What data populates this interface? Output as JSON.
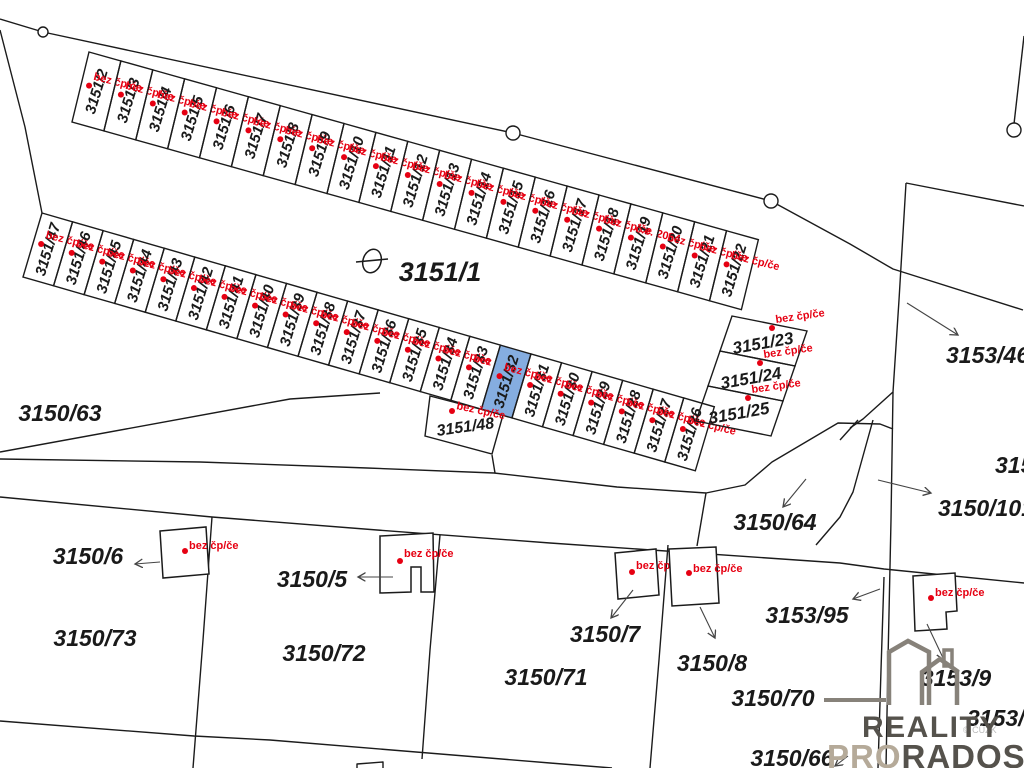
{
  "map": {
    "colors": {
      "background": "#ffffff",
      "line": "#1b1b1b",
      "label": "#1a1a1a",
      "red": "#e60012",
      "highlight_fill": "#85ade0",
      "arrow": "#444444",
      "logo_dark": "#55524c",
      "logo_light": "#b5aa99",
      "watermark_grey": "#bcbcbc"
    },
    "strips": [
      {
        "id": "north-row",
        "origin": [
          89,
          52
        ],
        "dir": [
          0.963,
          0.27
        ],
        "spacing": 33.1,
        "side": [
          -17,
          70
        ],
        "num_rot": -73,
        "tag_rot": 14,
        "num_size": 15,
        "tag_size": 11,
        "cells": [
          {
            "num": "3151/2",
            "tag": "bez čp/če"
          },
          {
            "num": "3151/3",
            "tag": "bez čp/če"
          },
          {
            "num": "3151/4",
            "tag": "bez čp/če"
          },
          {
            "num": "3151/5",
            "tag": "bez čp/če"
          },
          {
            "num": "3151/6",
            "tag": "bez čp/če"
          },
          {
            "num": "3151/7",
            "tag": "bez čp/če"
          },
          {
            "num": "3151/8",
            "tag": "bez čp/če"
          },
          {
            "num": "3151/9",
            "tag": "bez čp/če"
          },
          {
            "num": "3151/10",
            "tag": "bez čp/če"
          },
          {
            "num": "3151/11",
            "tag": "bez čp/če"
          },
          {
            "num": "3151/12",
            "tag": "bez čp/če"
          },
          {
            "num": "3151/13",
            "tag": "bez čp/če"
          },
          {
            "num": "3151/14",
            "tag": "bez čp/če"
          },
          {
            "num": "3151/15",
            "tag": "bez čp/če"
          },
          {
            "num": "3151/16",
            "tag": "bez čp/če"
          },
          {
            "num": "3151/17",
            "tag": "bez čp/če"
          },
          {
            "num": "3151/18",
            "tag": "bez čp/če"
          },
          {
            "num": "3151/19",
            "tag": "č.e. 2024"
          },
          {
            "num": "3151/20",
            "tag": "bez čp/če"
          },
          {
            "num": "3151/21",
            "tag": "bez čp/če"
          },
          {
            "num": "3151/22",
            "tag": "bez čp/če"
          }
        ]
      },
      {
        "id": "south-row",
        "origin": [
          42,
          213
        ],
        "dir": [
          0.961,
          0.277
        ],
        "spacing": 31.8,
        "side": [
          -19,
          64
        ],
        "num_rot": -73,
        "tag_rot": 14,
        "num_size": 15,
        "tag_size": 11,
        "cells": [
          {
            "num": "3151/47",
            "tag": "bez čp/če"
          },
          {
            "num": "3151/46",
            "tag": "bez čp/če"
          },
          {
            "num": "3151/45",
            "tag": "bez čp/če"
          },
          {
            "num": "3151/44",
            "tag": "bez čp/če"
          },
          {
            "num": "3151/43",
            "tag": "bez čp/če"
          },
          {
            "num": "3151/42",
            "tag": "bez čp/če"
          },
          {
            "num": "3151/41",
            "tag": "bez čp/če"
          },
          {
            "num": "3151/40",
            "tag": "bez čp/če"
          },
          {
            "num": "3151/39",
            "tag": "bez čp/če"
          },
          {
            "num": "3151/38",
            "tag": "bez čp/če"
          },
          {
            "num": "3151/37",
            "tag": "bez čp/če"
          },
          {
            "num": "3151/36",
            "tag": "bez čp/če"
          },
          {
            "num": "3151/35",
            "tag": "bez čp/če"
          },
          {
            "num": "3151/34",
            "tag": "bez čp/če"
          },
          {
            "num": "3151/33",
            "tag": "bez čp/če"
          },
          {
            "num": "3151/32",
            "tag": "bez čp/če",
            "highlight": true
          },
          {
            "num": "3151/31",
            "tag": "bez čp/če"
          },
          {
            "num": "3151/30",
            "tag": "bez čp/če"
          },
          {
            "num": "3151/29",
            "tag": "bez čp/če"
          },
          {
            "num": "3151/28",
            "tag": "bez čp/če"
          },
          {
            "num": "3151/27",
            "tag": "bez čp/če"
          },
          {
            "num": "3151/26",
            "tag": "bez čp/če"
          }
        ]
      }
    ],
    "east_block": {
      "origin": [
        732,
        316
      ],
      "rowvec": [
        75,
        15
      ],
      "colvec": [
        -12,
        35
      ],
      "num_rot": -10,
      "tag_rot": -8,
      "num_size": 17,
      "tag_size": 11,
      "cells": [
        {
          "num": "3151/23",
          "tag": "bez čp/če"
        },
        {
          "num": "3151/24",
          "tag": "bez čp/če"
        },
        {
          "num": "3151/25",
          "tag": "bez čp/če"
        }
      ]
    },
    "labels": [
      {
        "t": "3151/1",
        "x": 440,
        "y": 281,
        "s": 27
      },
      {
        "t": "3150/63",
        "x": 60,
        "y": 421,
        "s": 23
      },
      {
        "t": "3150/6",
        "x": 88,
        "y": 564,
        "s": 23
      },
      {
        "t": "3150/73",
        "x": 95,
        "y": 646,
        "s": 23
      },
      {
        "t": "3150/5",
        "x": 312,
        "y": 587,
        "s": 23
      },
      {
        "t": "3150/72",
        "x": 324,
        "y": 661,
        "s": 23
      },
      {
        "t": "3150/71",
        "x": 546,
        "y": 685,
        "s": 23
      },
      {
        "t": "3150/7",
        "x": 605,
        "y": 642,
        "s": 23
      },
      {
        "t": "3150/8",
        "x": 712,
        "y": 671,
        "s": 23
      },
      {
        "t": "3150/64",
        "x": 775,
        "y": 530,
        "s": 23
      },
      {
        "t": "3150/70",
        "x": 773,
        "y": 706,
        "s": 23
      },
      {
        "t": "3150/66",
        "x": 792,
        "y": 766,
        "s": 23
      },
      {
        "t": "3153/95",
        "x": 807,
        "y": 623,
        "s": 23
      },
      {
        "t": "3153/9",
        "x": 956,
        "y": 686,
        "s": 23
      },
      {
        "t": "3153/4",
        "x": 967,
        "y": 726,
        "s": 23,
        "anchor": "start"
      },
      {
        "t": "3153/46",
        "x": 946,
        "y": 363,
        "s": 23,
        "anchor": "start"
      },
      {
        "t": "3150/101",
        "x": 938,
        "y": 516,
        "s": 23,
        "anchor": "start"
      },
      {
        "t": "315",
        "x": 995,
        "y": 473,
        "s": 23,
        "anchor": "start"
      },
      {
        "t": "3151/48",
        "x": 466,
        "y": 432,
        "s": 16,
        "rot": -8
      }
    ],
    "buildings": [
      {
        "points": [
          [
            160,
            531
          ],
          [
            206,
            527
          ],
          [
            209,
            574
          ],
          [
            163,
            578
          ]
        ],
        "dot": [
          185,
          551
        ],
        "label": [
          189,
          549
        ],
        "tag": "bez čp/če"
      },
      {
        "points": [
          [
            380,
            536
          ],
          [
            433,
            533
          ],
          [
            434,
            592
          ],
          [
            421,
            592
          ],
          [
            421,
            567
          ],
          [
            411,
            567
          ],
          [
            411,
            592
          ],
          [
            380,
            593
          ]
        ],
        "dot": [
          400,
          561
        ],
        "label": [
          404,
          557
        ],
        "tag": "bez čp/če"
      },
      {
        "points": [
          [
            615,
            553
          ],
          [
            656,
            549
          ],
          [
            659,
            595
          ],
          [
            618,
            599
          ]
        ],
        "dot": [
          632,
          572
        ],
        "label": [
          636,
          569
        ],
        "tag": "bez čp/če"
      },
      {
        "points": [
          [
            669,
            549
          ],
          [
            716,
            547
          ],
          [
            719,
            603
          ],
          [
            672,
            606
          ]
        ],
        "dot": [
          689,
          573
        ],
        "label": [
          693,
          572
        ],
        "tag": "bez čp/če"
      },
      {
        "points": [
          [
            913,
            576
          ],
          [
            955,
            573
          ],
          [
            957,
            611
          ],
          [
            946,
            612
          ],
          [
            947,
            629
          ],
          [
            915,
            631
          ]
        ],
        "dot": [
          931,
          598
        ],
        "label": [
          935,
          596
        ],
        "tag": "bez čp/če"
      }
    ],
    "extra_tags": [
      {
        "dot": [
          452,
          411
        ],
        "label": [
          456,
          409
        ],
        "rot": 12,
        "tag": "bez čp/če"
      }
    ],
    "polylines": [
      {
        "pts": [
          [
            0,
            19
          ],
          [
            43,
            32
          ],
          [
            513,
            133
          ],
          [
            771,
            201
          ]
        ]
      },
      {
        "pts": [
          [
            771,
            201
          ],
          [
            850,
            244
          ],
          [
            893,
            269
          ],
          [
            1023,
            310
          ]
        ]
      },
      {
        "pts": [
          [
            1024,
            36
          ],
          [
            1014,
            124
          ]
        ]
      },
      {
        "pts": [
          [
            906,
            183
          ],
          [
            1024,
            206
          ]
        ]
      },
      {
        "pts": [
          [
            906,
            183
          ],
          [
            899,
            300
          ],
          [
            893,
            392
          ],
          [
            863,
            419
          ],
          [
            850,
            428
          ]
        ]
      },
      {
        "pts": [
          [
            893,
            392
          ],
          [
            891,
            520
          ],
          [
            888,
            660
          ],
          [
            886,
            768
          ]
        ]
      },
      {
        "pts": [
          [
            884,
            577
          ],
          [
            881,
            670
          ],
          [
            878,
            768
          ]
        ]
      },
      {
        "pts": [
          [
            0,
            30
          ],
          [
            25,
            127
          ],
          [
            42,
            213
          ]
        ]
      },
      {
        "pts": [
          [
            0,
            452
          ],
          [
            290,
            399
          ],
          [
            380,
            393
          ]
        ]
      },
      {
        "pts": [
          [
            0,
            459
          ],
          [
            200,
            462
          ],
          [
            367,
            468
          ],
          [
            494,
            473
          ],
          [
            617,
            487
          ],
          [
            706,
            493
          ]
        ]
      },
      {
        "pts": [
          [
            706,
            493
          ],
          [
            745,
            485
          ],
          [
            772,
            462
          ],
          [
            838,
            423
          ],
          [
            880,
            424
          ],
          [
            893,
            429
          ]
        ]
      },
      {
        "pts": [
          [
            706,
            493
          ],
          [
            697,
            546
          ]
        ]
      },
      {
        "pts": [
          [
            0,
            497
          ],
          [
            212,
            517
          ],
          [
            377,
            530
          ],
          [
            550,
            543
          ],
          [
            840,
            563
          ],
          [
            884,
            569
          ],
          [
            1024,
            583
          ]
        ]
      },
      {
        "pts": [
          [
            212,
            517
          ],
          [
            203,
            640
          ],
          [
            193,
            768
          ]
        ]
      },
      {
        "pts": [
          [
            0,
            721
          ],
          [
            194,
            736
          ],
          [
            270,
            740
          ],
          [
            550,
            763
          ],
          [
            612,
            768
          ]
        ]
      },
      {
        "pts": [
          [
            440,
            535
          ],
          [
            430,
            650
          ],
          [
            422,
            759
          ]
        ]
      },
      {
        "pts": [
          [
            668,
            545
          ],
          [
            659,
            660
          ],
          [
            650,
            768
          ]
        ]
      },
      {
        "pts": [
          [
            492,
            455
          ],
          [
            495,
            473
          ]
        ]
      },
      {
        "pts": [
          [
            873,
            420
          ],
          [
            853,
            492
          ],
          [
            840,
            517
          ],
          [
            816,
            545
          ]
        ]
      },
      {
        "pts": [
          [
            858,
            420
          ],
          [
            840,
            440
          ]
        ]
      },
      {
        "pts": [
          [
            357,
            768
          ],
          [
            357,
            764
          ],
          [
            383,
            762
          ],
          [
            383,
            768
          ]
        ]
      }
    ],
    "polygons": [
      {
        "pts": [
          [
            430,
            396
          ],
          [
            503,
            415
          ],
          [
            492,
            454
          ],
          [
            425,
            436
          ]
        ]
      }
    ],
    "boundary_markers": [
      {
        "x": 43,
        "y": 32,
        "r": 5
      },
      {
        "x": 513,
        "y": 133,
        "r": 7
      },
      {
        "x": 771,
        "y": 201,
        "r": 7
      },
      {
        "x": 1014,
        "y": 130,
        "r": 7
      }
    ],
    "gate_symbol": {
      "cx": 372,
      "cy": 261,
      "rx": 9,
      "ry": 12,
      "rot": 18,
      "x1": 356,
      "y1": 262,
      "x2": 388,
      "y2": 259
    },
    "arrows": [
      {
        "from": [
          160,
          562
        ],
        "to": [
          135,
          564
        ]
      },
      {
        "from": [
          393,
          577
        ],
        "to": [
          358,
          577
        ]
      },
      {
        "from": [
          633,
          590
        ],
        "to": [
          611,
          618
        ]
      },
      {
        "from": [
          700,
          607
        ],
        "to": [
          715,
          638
        ]
      },
      {
        "from": [
          880,
          589
        ],
        "to": [
          853,
          599
        ]
      },
      {
        "from": [
          927,
          624
        ],
        "to": [
          944,
          660
        ]
      },
      {
        "from": [
          907,
          303
        ],
        "to": [
          958,
          335
        ]
      },
      {
        "from": [
          878,
          480
        ],
        "to": [
          931,
          493
        ]
      },
      {
        "from": [
          806,
          479
        ],
        "to": [
          783,
          507
        ]
      },
      {
        "from": [
          848,
          756
        ],
        "to": [
          835,
          766
        ]
      }
    ],
    "logo": {
      "line1": "REALITY",
      "line2a": "PRO",
      "line2b": "RADOST",
      "watermark": "© ČÚZK"
    }
  }
}
